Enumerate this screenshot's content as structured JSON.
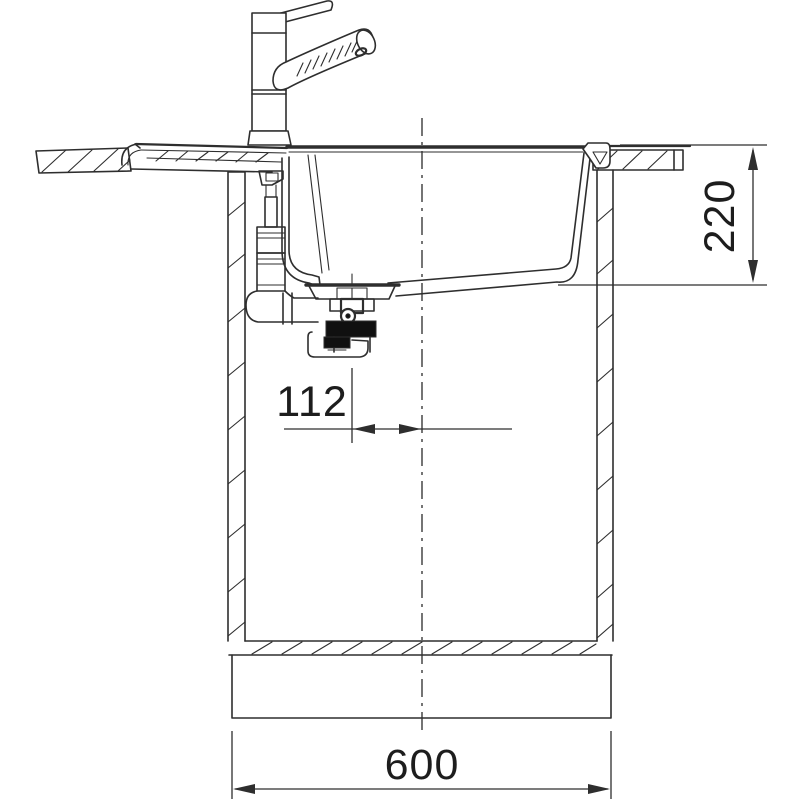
{
  "drawing": {
    "dimensions": {
      "depth": "220",
      "drain_offset": "112",
      "width": "600"
    },
    "colors": {
      "line": "#2e2e2e",
      "background": "#ffffff",
      "solid_fill": "#101010"
    }
  }
}
